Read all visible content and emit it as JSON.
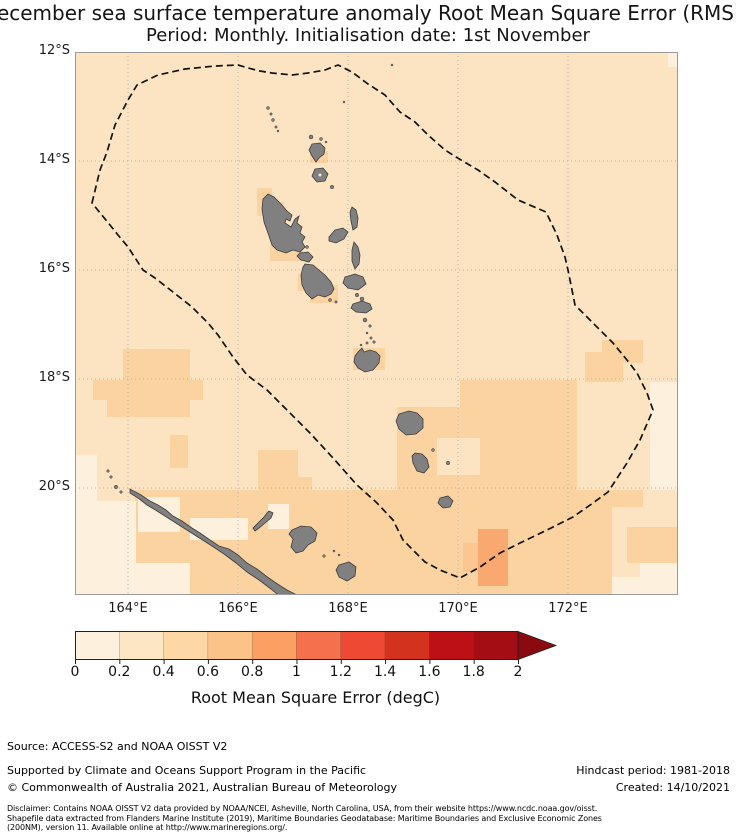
{
  "title": {
    "line1": "December sea surface temperature anomaly Root Mean Square Error (RMSE)",
    "line2": "Period: Monthly. Initialisation date: 1st November"
  },
  "map": {
    "frame": {
      "x": 75,
      "y": 52,
      "w": 603,
      "h": 543
    },
    "lat_ticks": [
      {
        "label": "12°S",
        "y": 52
      },
      {
        "label": "14°S",
        "y": 161
      },
      {
        "label": "16°S",
        "y": 270
      },
      {
        "label": "18°S",
        "y": 379
      },
      {
        "label": "20°S",
        "y": 488
      }
    ],
    "lon_ticks": [
      {
        "label": "164°E",
        "x": 128
      },
      {
        "label": "166°E",
        "x": 238
      },
      {
        "label": "168°E",
        "x": 348
      },
      {
        "label": "170°E",
        "x": 458
      },
      {
        "label": "172°E",
        "x": 568
      }
    ],
    "colors": {
      "base": "#fce4c3",
      "p0": "#fdf0dc",
      "p2": "#fbd3a1",
      "p3": "#fbc68f",
      "p4": "#f9a96f",
      "island": "#808080",
      "island_edge": "#3c3c3c",
      "grid": "#b9b1a4",
      "frame_edge": "#9a9a9a",
      "eez": "#111111"
    },
    "patches": [
      [
        257,
        188,
        15,
        28,
        "p2"
      ],
      [
        270,
        202,
        14,
        14,
        "p2"
      ],
      [
        270,
        245,
        33,
        16,
        "p2"
      ],
      [
        310,
        151,
        18,
        12,
        "p2"
      ],
      [
        298,
        274,
        20,
        17,
        "p2"
      ],
      [
        310,
        285,
        28,
        18,
        "p2"
      ],
      [
        353,
        348,
        32,
        22,
        "p2"
      ],
      [
        123,
        349,
        67,
        31,
        "p2"
      ],
      [
        93,
        380,
        110,
        20,
        "p2"
      ],
      [
        107,
        400,
        83,
        17,
        "p2"
      ],
      [
        170,
        435,
        18,
        33,
        "p2"
      ],
      [
        258,
        450,
        40,
        40,
        "p2"
      ],
      [
        298,
        477,
        14,
        13,
        "p2"
      ],
      [
        135,
        490,
        477,
        105,
        "p2"
      ],
      [
        397,
        407,
        83,
        83,
        "p2"
      ],
      [
        460,
        380,
        117,
        110,
        "p2"
      ],
      [
        602,
        340,
        41,
        23,
        "p2"
      ],
      [
        585,
        352,
        38,
        30,
        "p2"
      ],
      [
        612,
        490,
        31,
        17,
        "p2"
      ],
      [
        627,
        527,
        51,
        36,
        "p2"
      ],
      [
        75,
        455,
        22,
        46,
        "p0"
      ],
      [
        75,
        501,
        61,
        94,
        "p0"
      ],
      [
        136,
        563,
        54,
        32,
        "p0"
      ],
      [
        138,
        497,
        42,
        35,
        "p0"
      ],
      [
        190,
        518,
        58,
        22,
        "p0"
      ],
      [
        268,
        504,
        21,
        25,
        "p0"
      ],
      [
        650,
        382,
        28,
        108,
        "p0"
      ],
      [
        640,
        563,
        38,
        32,
        "p0"
      ],
      [
        612,
        577,
        66,
        18,
        "p0"
      ],
      [
        668,
        52,
        10,
        15,
        "p0"
      ],
      [
        437,
        438,
        43,
        37,
        "base"
      ],
      [
        463,
        543,
        15,
        29,
        "p3"
      ],
      [
        478,
        529,
        30,
        57,
        "p4"
      ]
    ],
    "eez": [
      [
        92,
        203
      ],
      [
        100,
        170
      ],
      [
        107,
        152
      ],
      [
        115,
        125
      ],
      [
        128,
        100
      ],
      [
        137,
        85
      ],
      [
        158,
        75
      ],
      [
        185,
        69
      ],
      [
        215,
        66
      ],
      [
        238,
        65
      ],
      [
        248,
        68
      ],
      [
        260,
        71
      ],
      [
        272,
        73
      ],
      [
        292,
        75
      ],
      [
        308,
        73
      ],
      [
        325,
        70
      ],
      [
        338,
        65
      ],
      [
        352,
        72
      ],
      [
        368,
        84
      ],
      [
        385,
        95
      ],
      [
        400,
        112
      ],
      [
        415,
        122
      ],
      [
        428,
        135
      ],
      [
        445,
        150
      ],
      [
        456,
        157
      ],
      [
        478,
        170
      ],
      [
        495,
        182
      ],
      [
        518,
        200
      ],
      [
        546,
        212
      ],
      [
        557,
        235
      ],
      [
        565,
        257
      ],
      [
        568,
        270
      ],
      [
        575,
        305
      ],
      [
        588,
        318
      ],
      [
        600,
        330
      ],
      [
        613,
        343
      ],
      [
        627,
        360
      ],
      [
        637,
        373
      ],
      [
        647,
        393
      ],
      [
        653,
        410
      ],
      [
        640,
        440
      ],
      [
        627,
        463
      ],
      [
        608,
        492
      ],
      [
        593,
        503
      ],
      [
        573,
        517
      ],
      [
        547,
        530
      ],
      [
        520,
        543
      ],
      [
        500,
        553
      ],
      [
        480,
        567
      ],
      [
        460,
        578
      ],
      [
        440,
        570
      ],
      [
        425,
        562
      ],
      [
        403,
        540
      ],
      [
        393,
        520
      ],
      [
        377,
        503
      ],
      [
        357,
        485
      ],
      [
        333,
        458
      ],
      [
        310,
        433
      ],
      [
        287,
        410
      ],
      [
        267,
        390
      ],
      [
        247,
        375
      ],
      [
        233,
        357
      ],
      [
        218,
        335
      ],
      [
        208,
        323
      ],
      [
        192,
        307
      ],
      [
        173,
        292
      ],
      [
        155,
        278
      ],
      [
        143,
        270
      ],
      [
        128,
        247
      ],
      [
        118,
        235
      ],
      [
        110,
        225
      ]
    ],
    "islands": [
      {
        "name": "espiritu-santo",
        "d": "M268,194 L274,197 L281,204 L287,211 L292,215 L290,221 L286,219 L285,223 L291,227 L295,219 L299,216 L297,223 L302,227 L300,233 L305,237 L302,242 L305,247 L300,252 L293,250 L286,253 L277,250 L272,245 L269,236 L264,222 L262,209 L263,199 Z"
      },
      {
        "name": "malo",
        "d": "M300,253 L308,252 L313,257 L309,262 L301,260 L297,256 Z"
      },
      {
        "name": "vanua-lava",
        "d": "M312,144 L320,143 L325,148 L324,154 L319,158 L316,162 L312,156 L309,150 Z"
      },
      {
        "name": "gaua",
        "d": "M315,169 L323,168 L328,174 L325,181 L317,182 L312,176 Z"
      },
      {
        "name": "maewo",
        "d": "M352,207 L356,210 L358,218 L357,227 L353,230 L351,221 L350,212 Z"
      },
      {
        "name": "ambae",
        "d": "M329,237 L335,230 L343,228 L348,232 L344,239 L336,243 L329,241 Z"
      },
      {
        "name": "pentecost",
        "d": "M354,242 L358,247 L360,255 L359,264 L355,269 L352,261 L352,250 Z"
      },
      {
        "name": "malakula",
        "d": "M305,264 L313,265 L319,270 L325,275 L331,282 L334,289 L331,294 L325,297 L318,295 L312,299 L306,293 L302,285 L301,275 L303,267 Z"
      },
      {
        "name": "ambrym",
        "d": "M345,277 L355,274 L363,277 L366,284 L358,290 L348,288 L343,283 Z"
      },
      {
        "name": "epi",
        "d": "M353,304 L362,301 L370,304 L372,309 L366,313 L356,312 L351,308 Z"
      },
      {
        "name": "efate",
        "d": "M358,352 L362,348 L364,352 L370,350 L376,352 L380,356 L379,363 L373,370 L365,372 L358,368 L354,362 L355,356 Z"
      },
      {
        "name": "erromango",
        "d": "M399,414 L409,411 L417,413 L423,419 L423,428 L416,434 L406,435 L399,429 L396,421 Z"
      },
      {
        "name": "tanna",
        "d": "M415,453 L422,454 L427,459 L429,467 L424,473 L417,471 L413,463 L412,456 Z"
      },
      {
        "name": "aneityum",
        "d": "M440,498 L448,496 L453,501 L450,507 L443,508 L438,503 Z"
      },
      {
        "name": "grande-terre",
        "d": "M130,489 L141,495 L150,501 L158,505 L166,510 L173,516 L182,521 L192,528 L200,533 L210,540 L219,546 L229,549 L238,555 L247,563 L257,569 L266,576 L276,583 L287,590 L297,595 L304,599 L283,599 L271,589 L259,580 L247,572 L236,563 L224,554 L212,546 L201,539 L190,532 L179,525 L168,518 L157,511 L147,505 L138,498 L130,493 Z"
      },
      {
        "name": "ouvea",
        "d": "M269,511 L273,513 L271,518 L265,523 L259,528 L255,531 L253,528 L258,523 L264,517 L267,513 Z"
      },
      {
        "name": "lifou",
        "d": "M292,530 L301,526 L311,527 L317,533 L315,541 L308,545 L303,551 L296,553 L291,547 L293,539 L289,534 Z"
      },
      {
        "name": "mare",
        "d": "M339,565 L349,562 L356,567 L355,576 L347,581 L339,577 L336,570 Z"
      }
    ],
    "islets": [
      [
        268,
        108,
        1.5
      ],
      [
        271,
        114,
        1.2
      ],
      [
        273,
        120,
        1.5
      ],
      [
        276,
        127,
        1.2
      ],
      [
        278,
        131,
        1.0
      ],
      [
        311,
        137,
        2.0
      ],
      [
        321,
        139,
        1.5
      ],
      [
        326,
        142,
        1.0
      ],
      [
        332,
        187,
        1.8
      ],
      [
        344,
        102,
        1.0
      ],
      [
        392,
        65,
        1.0
      ],
      [
        307,
        247,
        1.5
      ],
      [
        330,
        300,
        1.5
      ],
      [
        336,
        302,
        1.2
      ],
      [
        357,
        295,
        1.8
      ],
      [
        362,
        299,
        2.0
      ],
      [
        365,
        320,
        2.0
      ],
      [
        370,
        326,
        1.3
      ],
      [
        367,
        333,
        1.0
      ],
      [
        371,
        338,
        1.2
      ],
      [
        374,
        342,
        1.3
      ],
      [
        361,
        345,
        1.0
      ],
      [
        367,
        343,
        1.2
      ],
      [
        433,
        450,
        1.5
      ],
      [
        448,
        463,
        1.8
      ],
      [
        108,
        471,
        1.3
      ],
      [
        111,
        477,
        1.3
      ],
      [
        116,
        487,
        1.8
      ],
      [
        121,
        492,
        1.3
      ],
      [
        324,
        556,
        1.3
      ],
      [
        334,
        551,
        1.0
      ],
      [
        339,
        555,
        1.0
      ]
    ],
    "lake": [
      320,
      175,
      1.5
    ]
  },
  "colorbar": {
    "x": 75,
    "y": 631,
    "seg_w": 44.3,
    "bar_h": 28,
    "arrow_w": 38,
    "segments": [
      "#fdf0dc",
      "#fde6c4",
      "#fdd7a6",
      "#fcc389",
      "#fc9f63",
      "#f4714b",
      "#ee4a33",
      "#d3321f",
      "#bc1016",
      "#a30d13"
    ],
    "arrow_color": "#8b0a10",
    "ticks": [
      "0",
      "0.2",
      "0.4",
      "0.6",
      "0.8",
      "1",
      "1.2",
      "1.4",
      "1.6",
      "1.8",
      "2"
    ],
    "label": "Root Mean Square Error (degC)"
  },
  "footer": {
    "source": "Source: ACCESS-S2 and NOAA OISST V2",
    "supported": "Supported by Climate and Oceans Support Program in the Pacific",
    "copyright": "© Commonwealth of Australia 2021, Australian Bureau of Meteorology",
    "hindcast": "Hindcast period: 1981-2018",
    "created": "Created: 14/10/2021",
    "disclaimer_lines": [
      "Disclaimer: Contains NOAA OISST V2 data provided by NOAA/NCEI, Asheville, North Carolina, USA, from their website https://www.ncdc.noaa.gov/oisst.",
      "Shapefile data extracted from Flanders Marine Institute (2019), Maritime Boundaries Geodatabase: Maritime Boundaries and Exclusive Economic Zones",
      "(200NM), version 11. Available online at http://www.marineregions.org/."
    ]
  }
}
